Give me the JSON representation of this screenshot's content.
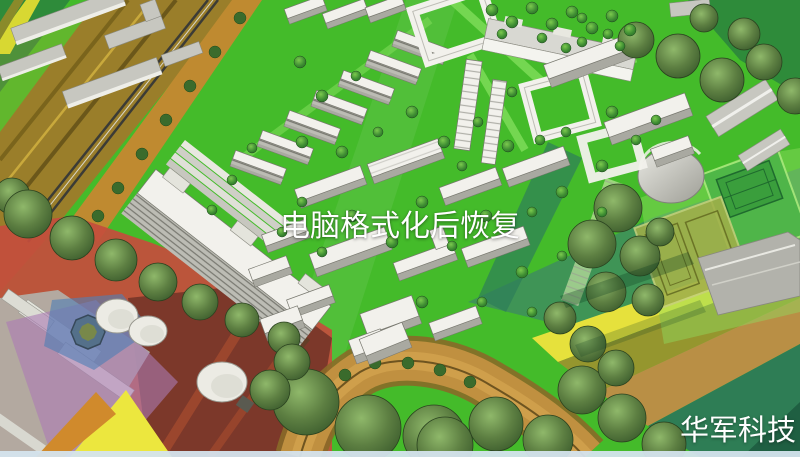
{
  "image_alt": "Aerial 3D rendering of an urban masterplan: white apartment buildings on bright green lawns, tree clusters, a railway corridor, tennis courts, storage tanks and colored zoning overlays",
  "overlay": {
    "title": "电脑格式化后恢复",
    "watermark": "华军科技"
  },
  "colors": {
    "title_text": "#ffffff",
    "watermark_text": "#ffffff",
    "lawn_green": "#44bb2a",
    "bright_green": "#66d93f",
    "field_teal": "#3f9456",
    "band_yellow": "#e6e13c",
    "band_olive": "#95962e",
    "road_tan": "#c09040",
    "railway_gold": "#9a7e2a",
    "zone_red": "#c44e3c",
    "zone_maroon": "#7c382a",
    "zone_violet": "#ab7cb4",
    "zone_blue": "#5080b5",
    "building_white": "#f2f1ec",
    "building_gray": "#b5b5ae",
    "tree_dark_green": "#3a5a2c"
  }
}
